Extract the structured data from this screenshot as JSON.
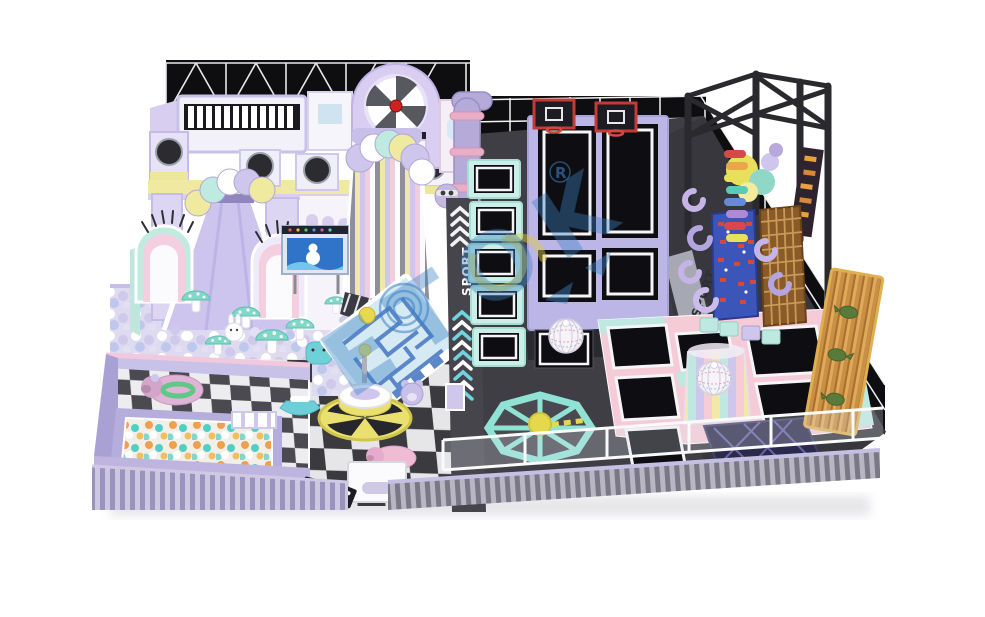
{
  "meta": {
    "type": "3d-render",
    "subject": "pastel indoor playground with trampoline park, castle play structure, ball pits and climbing tower",
    "canvas_width": 985,
    "canvas_height": 617,
    "background": "#ffffff"
  },
  "watermark": {
    "brand": "ETOK",
    "registered_mark": "R",
    "color": "#3b82c4",
    "accent_color": "#e0cc3c"
  },
  "track_labels": {
    "left": "SPORT",
    "right": "SPORT"
  },
  "palette": {
    "wall_black": "#0e0e10",
    "wall_line_white": "#f5f5f7",
    "floor_dark": "#3f3e44",
    "floor_darker": "#2b2a30",
    "lavender": "#c7bfe8",
    "lavender_deep": "#a9a1d4",
    "pink": "#f4cbd6",
    "mint": "#bfe9e0",
    "yellow": "#efe9a2",
    "mat_black": "#0e0e12",
    "frame_white": "#ffffff",
    "hoop_red": "#c23b34",
    "climb_wall_blue": "#3b55b8",
    "wood_brown": "#c98f45",
    "ball_orange": "#f09f4d",
    "ball_teal": "#52cfc4",
    "track_grey": "#46454c",
    "screen_blue": "#2f74c8",
    "carousel_yellow": "#e9e070",
    "navy_airbag": "#2c2a4a"
  },
  "zones": {
    "castle": "pastel castle playhouse with piano roof, clock arch and slides",
    "ball_pit": "white and lavender ball pit with mushroom decor",
    "toddler_area": "fenced toddler zone with colorful ball pool and ride-on pig",
    "checker_floor": "black and white checkered floor with carousel ride",
    "trampoline_court": "black trampoline mats with lavender, pink and mint frames",
    "dunk_lanes": "two basketball dunk trampoline lanes",
    "wrecking_balls": "two striped mesh wrecking balls",
    "windmill_sweeper": "mint octagon rotating sweeper game",
    "climbing_tower": "black steel frame tower with climbing walls",
    "dino_wall": "wooden climbing wall with dinosaur figures",
    "sport_tracks": "grey running strips with chevron arrows"
  }
}
